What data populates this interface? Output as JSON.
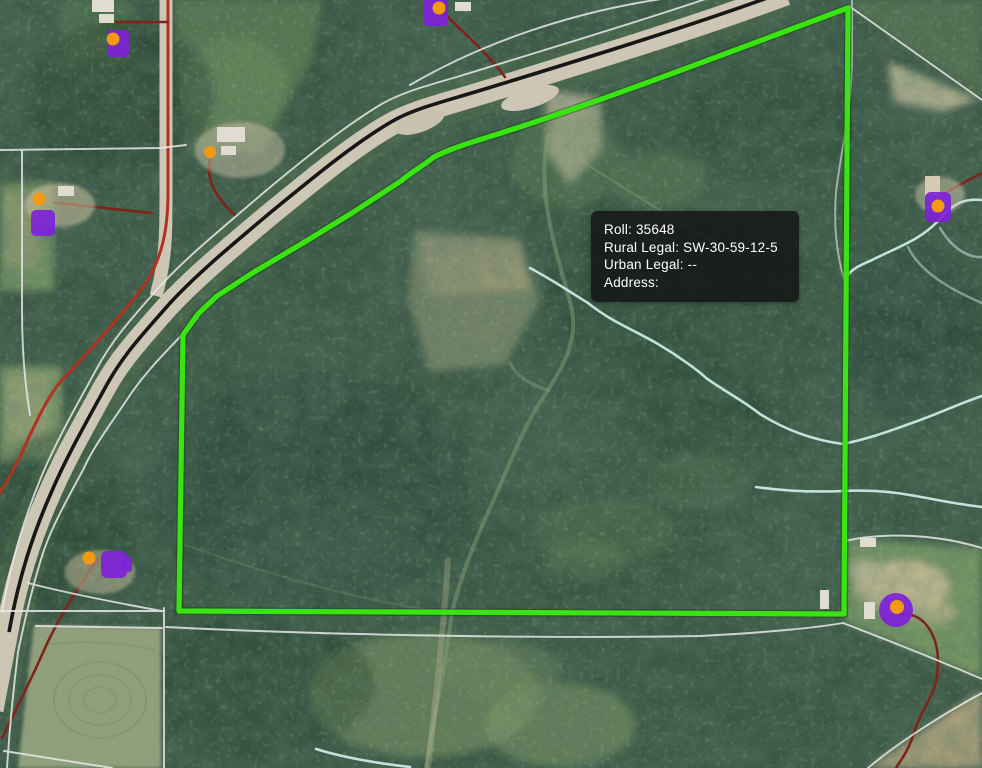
{
  "tooltip": {
    "roll_line": "Roll: 35648",
    "rural_legal_line": "Rural Legal: SW-30-59-12-5",
    "urban_legal_line": "Urban Legal: --",
    "address_line": "Address:"
  },
  "colors": {
    "parcel_highlight": "#3ae412",
    "road_overlay_red": "#b23222",
    "driveway_red": "#7e2418",
    "building_marker_purple": "#7e22d8",
    "site_marker_orange": "#f29a12",
    "stream_cyan": "#cdeeea",
    "parcel_line_white": "#e8e9ea",
    "road_surface": "#cdc6b5",
    "road_centerline_black": "#171717",
    "tooltip_background": "rgba(18,18,20,0.82)",
    "tooltip_text": "#ffffff"
  },
  "icons": {
    "building_marker": "purple-building-footprint-icon",
    "site_dot": "orange-site-dot-icon"
  }
}
